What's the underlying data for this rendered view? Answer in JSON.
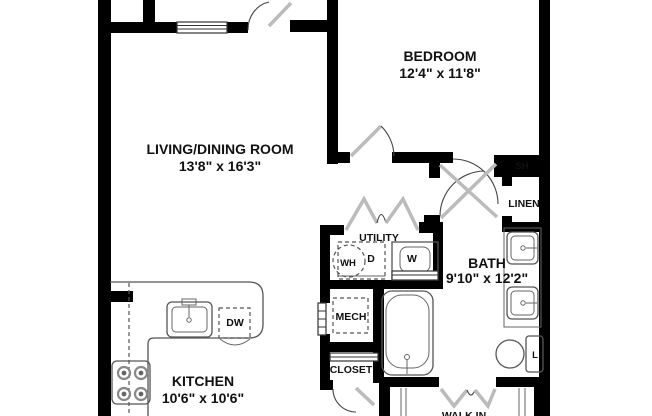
{
  "floorplan": {
    "title": "One-bedroom apartment floor plan",
    "rooms": {
      "living_dining": {
        "name": "LIVING/DINING ROOM",
        "dimensions": "13'8\" x 16'3\""
      },
      "bedroom": {
        "name": "BEDROOM",
        "dimensions": "12'4\" x 11'8\""
      },
      "kitchen": {
        "name": "KITCHEN",
        "dimensions": "10'6\" x 10'6\""
      },
      "bath": {
        "name": "BATH",
        "dimensions": "9'10\" x 12'2\""
      },
      "utility": {
        "name": "UTILITY"
      },
      "mech": {
        "name": "MECH"
      },
      "closet": {
        "name": "CLOSET"
      },
      "walk_in": {
        "name": "WALK IN"
      },
      "linen": {
        "name": "LINEN"
      },
      "shelf": {
        "name": "SH"
      }
    },
    "fixtures": {
      "dishwasher": "DW",
      "washer": "W",
      "dryer": "D",
      "water_heater": "WH",
      "linen_cabinet": "L"
    },
    "colors": {
      "wall": "#000000",
      "background": "#ffffff",
      "fixture_line": "#555555",
      "door_leaf": "#bbbbbb"
    }
  }
}
